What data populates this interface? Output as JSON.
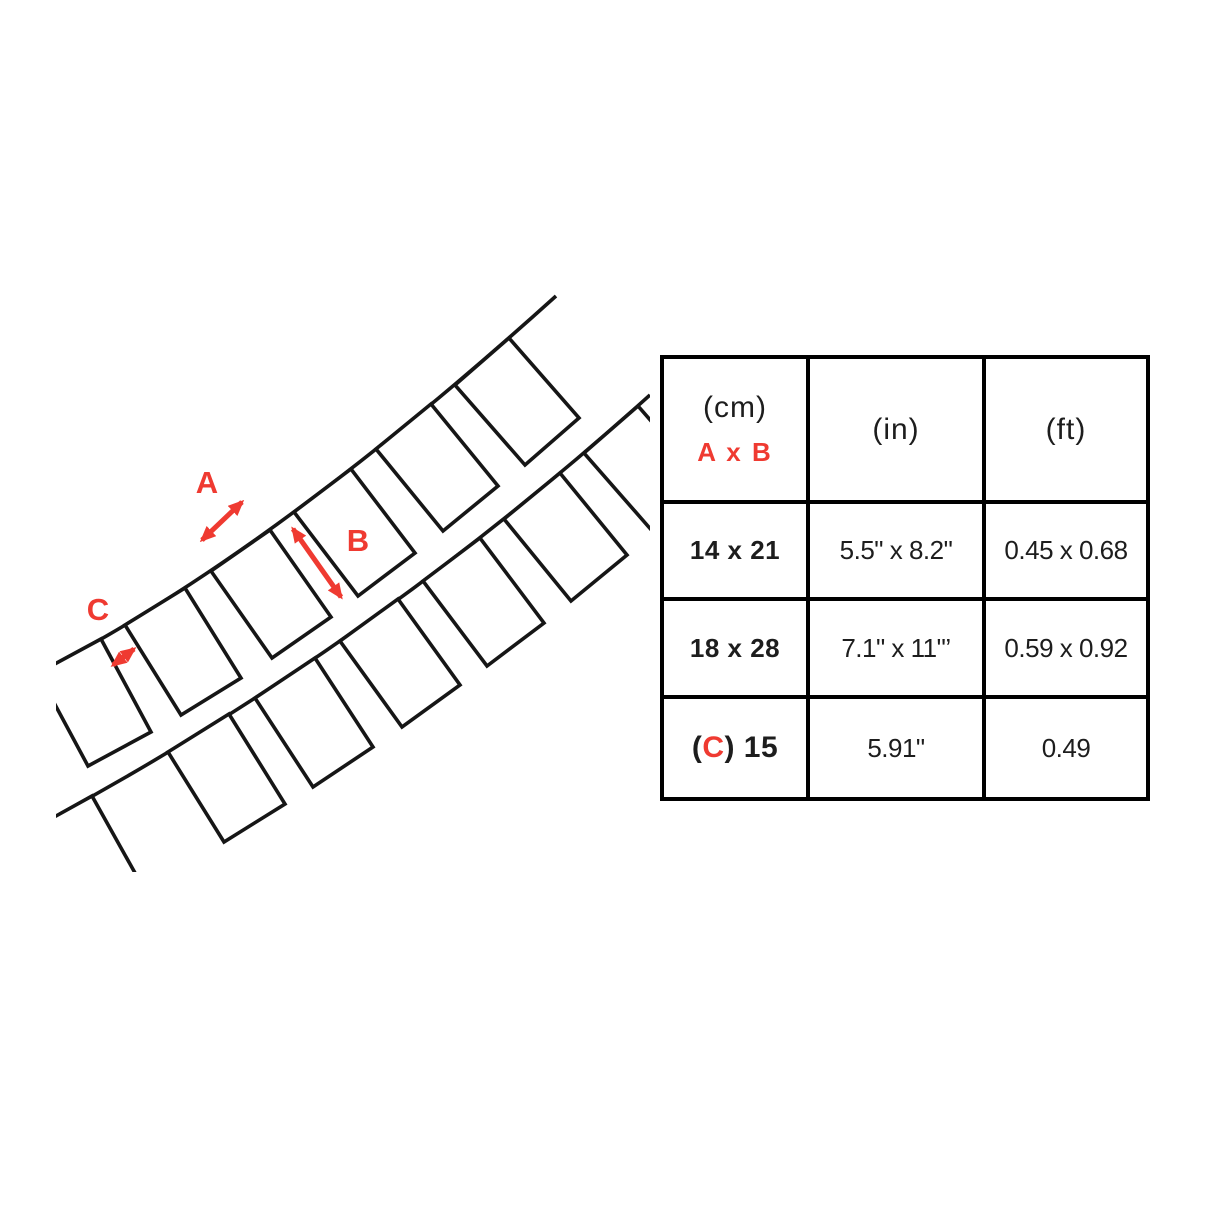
{
  "colors": {
    "accent": "#ef3a31",
    "ink": "#161616"
  },
  "diagram": {
    "label_a": "A",
    "label_b": "B",
    "label_c": "C"
  },
  "table": {
    "header": {
      "cm_unit": "(cm)",
      "cm_sub": "A x B",
      "in_unit": "(in)",
      "ft_unit": "(ft)"
    },
    "rows": [
      {
        "cm": "14 x 21",
        "inch": "5.5\" x 8.2\"",
        "feet": "0.45 x 0.68"
      },
      {
        "cm": "18 x 28",
        "inch": "7.1\" x 11\"’",
        "feet": "0.59 x 0.92"
      },
      {
        "cm_open": "(",
        "cm_c": "C",
        "cm_close": ") 15",
        "inch": "5.91\"",
        "feet": "0.49"
      }
    ]
  }
}
